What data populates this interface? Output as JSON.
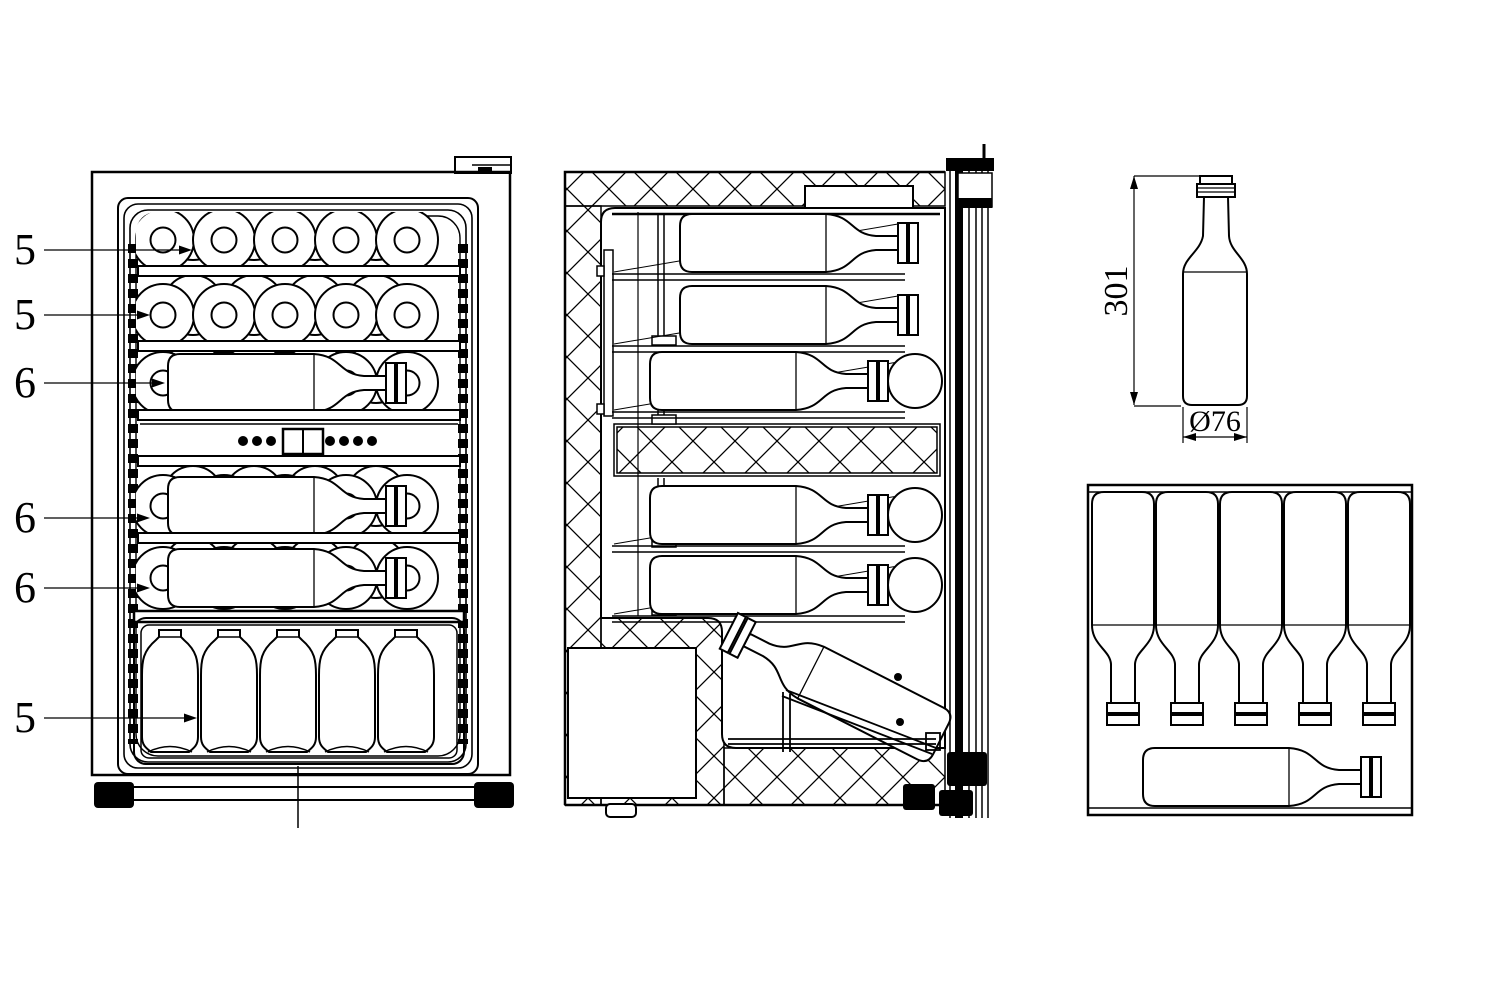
{
  "colors": {
    "line": "#000000",
    "background": "#ffffff"
  },
  "part_labels": [
    {
      "text": "5"
    },
    {
      "text": "5"
    },
    {
      "text": "6"
    },
    {
      "text": "6"
    },
    {
      "text": "6"
    },
    {
      "text": "5"
    }
  ],
  "bottle_dimensions": {
    "height": "301",
    "diameter": "Ø76"
  }
}
